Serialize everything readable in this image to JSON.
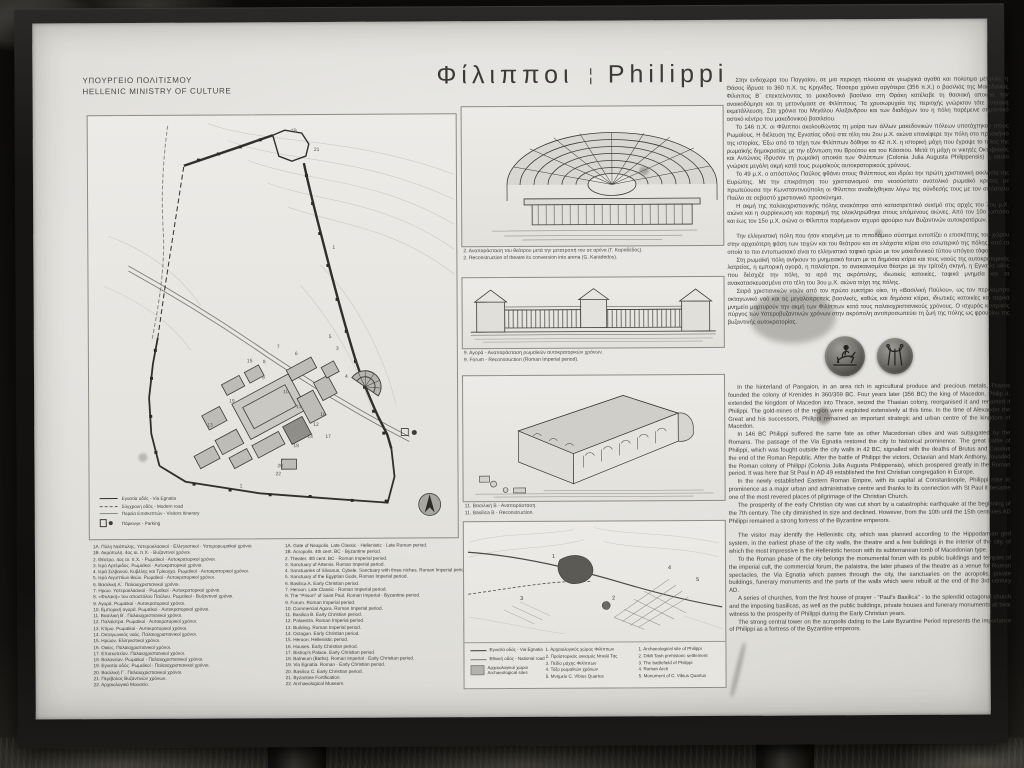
{
  "colors": {
    "frame": "#171513",
    "board": "#e2e1dc",
    "ink": "#3e3e3a",
    "wall_line": "#2f2f2d",
    "coin": "#55544e"
  },
  "header": {
    "ministry_line1": "ΥΠΟΥΡΓΕΙΟ ΠΟΛΙΤΙΣΜΟΥ",
    "ministry_line2": "HELLENIC MINISTRY OF CULTURE",
    "title_greek": "Φίλιπποι",
    "title_divider": "¦",
    "title_english": "Philippi"
  },
  "site_map": {
    "legend": [
      "Εγνατία οδός - Via Egnatia",
      "Σύγχρονη οδός - Modern road",
      "Πορεία Επισκεπτών - Visitors Itinerary",
      "Πάρκινγκ - Parking"
    ]
  },
  "monument_legend": {
    "greek": [
      "1Α. Πύλη Νεάπολης. Υστεροκλασικοί - Ελληνιστικοί - Υστερορωμαϊκοί χρόνοι.",
      "1Β. Ακρόπολη. 4ος αι. π.Χ. - Βυζαντινοί χρόνοι.",
      "2. Θέατρο. 4ος αι. π.Χ. - Ρωμαϊκοί - Αυτοκρατορικοί χρόνοι.",
      "3. Ιερό Αρτέμιδος. Ρωμαϊκοί - Αυτοκρατορικοί χρόνοι.",
      "4. Ιερά Σιλβανού, Κυβέλης και Τρίκογχο. Ρωμαϊκοί - Αυτοκρατορικοί χρόνοι.",
      "5. Ιερό Αιγυπτίων θεών. Ρωμαϊκοί - Αυτοκρατορικοί χρόνοι.",
      "6. Βασιλική Α΄. Παλαιοχριστιανικοί χρόνοι.",
      "7. Ηρώο. Υστεροκλασικοί - Ρωμαϊκοί - Αυτοκρατορικοί χρόνοι.",
      "8. «Φυλακή» του αποστόλου Παύλου. Ρωμαϊκοί - Βυζαντινοί χρόνοι.",
      "9. Αγορά. Ρωμαϊκοί - Αυτοκρατορικοί χρόνοι.",
      "10. Εμπορική αγορά. Ρωμαϊκοί - Αυτοκρατορικοί χρόνοι.",
      "11. Βασιλική Β΄. Παλαιοχριστιανικοί χρόνοι.",
      "12. Παλαίστρα. Ρωμαϊκοί - Αυτοκρατορικοί χρόνοι.",
      "13. Κτίριο. Ρωμαϊκοί - Αυτοκρατορικοί χρόνοι.",
      "14. Οκταγωνικός ναός. Παλαιοχριστιανικοί χρόνοι.",
      "15. Ηρώον. Ελληνιστικοί χρόνοι.",
      "16. Οικίες. Παλαιοχριστιανικοί χρόνοι.",
      "17. Επισκοπείον. Παλαιοχριστιανικοί χρόνοι.",
      "18. Βαλανείον. Ρωμαϊκοί - Παλαιοχριστιανικοί χρόνοι.",
      "19. Εγνατία οδός. Ρωμαϊκοί - Παλαιοχριστιανικοί χρόνοι.",
      "20. Βασιλική Γ΄. Παλαιοχριστιανικοί χρόνοι.",
      "21. Περίβολος Βυζαντινών χρόνων.",
      "22. Αρχαιολογικό Μουσείο."
    ],
    "english": [
      "1A. Gate of Neapolis. Late Classic - Hellenistic - Late Roman period.",
      "1B. Acropolis. 4th cent. BC - Byzantine period.",
      "2. Theater. 4th cent. BC - Roman Imperial period.",
      "3. Sanctuary of Artemis. Roman Imperial period.",
      "4. Sanctuaries of Silvanus, Cybele. Sanctuary with three niches. Roman Imperial period.",
      "5. Sanctuary of the Egyptian Gods. Roman Imperial period.",
      "6. Basilica A. Early Christian period.",
      "7. Heroon. Late Classic - Roman Imperial period.",
      "8. The \"Prison\" of Saint Paul. Roman Imperial - Byzantine period.",
      "9. Forum. Roman Imperial period.",
      "10. Commercial Agora. Roman Imperial period.",
      "11. Basilica B. Early Christian period.",
      "12. Palaestra. Roman Imperial period.",
      "13. Building. Roman Imperial period.",
      "14. Octagon. Early Christian period.",
      "15. Heroon. Hellenistic period.",
      "16. Houses. Early Christian period.",
      "17. Bishop's Palace. Early Christian period.",
      "18. Balneum (Baths). Roman Imperial - Early Christian period.",
      "19. Via Egnatia. Roman - Early Christian period.",
      "20. Basilica C. Early Christian period.",
      "21. Byzantine Fortification.",
      "22. Archaeological Museum."
    ]
  },
  "figures": [
    {
      "greek": "2. Αναπαράσταση του θεάτρου μετά την μετατροπή του σε αρένα (Γ. Καραδέδος).",
      "english": "2. Reconstruction of theatre its conversion into arena (G. Karadedos)."
    },
    {
      "greek": "9. Αγορά - Αναπαράσταση ρωμαϊκών αυτοκρατορικών χρόνων.",
      "english": "9. Forum - Reconstruction (Roman Imperial period)."
    },
    {
      "greek": "11. Βασιλική Β - Αναπαράσταση.",
      "english": "11. Basilica B - Reconstruction."
    }
  ],
  "area_map": {
    "legend_roads": [
      "Εγνατία οδός - Via Egnatia",
      "Εθνική οδός - National road"
    ],
    "legend_sites_greek": "Αρχαιολογικοί χώροι",
    "legend_sites_english": "Archaeological sites",
    "points_greek": [
      "1. Αρχαιολογικός χώρος Φιλίππων",
      "2. Προϊστορικός οικισμός Ντικιλί Τας",
      "3. Πεδίο μάχης Φιλίππων",
      "4. Τόξο ρωμαϊκών χρόνων",
      "5. Μνημείο C. Vibius Quartus"
    ],
    "points_english": [
      "1. Archaeological site of Philippi",
      "2. Dikili Tash prehistoric settlement",
      "3. The battlefield of Philippi",
      "4. Roman Arch",
      "5. Monument of C. Vibius Quartus"
    ]
  },
  "text_greek": {
    "part1": [
      "Στην ενδοχώρα του Παγγαίου, σε μια περιοχή πλούσια σε γεωργικά αγαθά και πολύτιμα μέταλλα, η Θάσος ίδρυσε το 360 π.Χ. τις Κρηνίδες. Τέσσερα χρόνια αργότερα (356 π.Χ.) ο βασιλιάς της Μακεδονίας Φίλιππος Β΄ επεκτείνοντας το μακεδονικό βασίλειο στη Θράκη κατέλαβε τη θασιακή αποικία, την ανοικοδόμησε και τη μετονόμασε σε Φιλίππους. Τα χρυσωρυχεία της περιοχής γνώρισαν τότε εντατική εκμετάλλευση. Στα χρόνια του Μεγάλου Αλεξάνδρου και των διαδόχων του η πόλη παρέμεινε σημαντικό αστικό κέντρο του μακεδονικού βασιλείου.",
      "Το 146 π.Χ. οι Φίλιπποι ακολουθώντας τη μοίρα των άλλων μακεδονικών πόλεων υποτάχτηκαν στους Ρωμαίους. Η διέλευση της Εγνατίας οδού στα τέλη του 2ου μ.Χ. αιώνα επανέφερε την πόλη στο προσκήνιο της ιστορίας. Έξω από τα τείχη των Φιλίππων δόθηκε το 42 π.Χ. η ιστορική μάχη που έγραψε το τέλος της ρωμαϊκής δημοκρατίας με την εξόντωση του Βρούτου και του Κάσσιου. Μετά τη μάχη οι νικητές Οκταβιανός και Αντώνιος ίδρυσαν τη ρωμαϊκή αποικία των Φιλίππων (Colonia Julia Augusta Philippensis) η οποία γνώρισε μεγάλη ακμή κατά τους ρωμαϊκούς αυτοκρατορικούς χρόνους.",
      "Το 49 μ.Χ. ο απόστολος Παύλος φθάνει στους Φιλίππους και ιδρύει την πρώτη χριστιανική εκκλησία της Ευρώπης. Με την επικράτηση του χριστιανισμού στο νεοσύστατο ανατολικό ρωμαϊκό κράτος με πρωτεύουσα την Κωνσταντινούπολη οι Φίλιπποι αναδείχθηκαν λόγω της σύνδεσής τους με τον απόστολο Παύλο σε σεβαστό χριστιανικό προσκύνημα.",
      "Η ακμή της παλαιοχριστιανικής πόλης ανακόπηκε από καταστρεπτικό σεισμό στις αρχές του 7ου μ.Χ. αιώνα και η συρρίκνωση και παρακμή της ολοκληρώθηκε στους επόμενους αιώνες. Από τον 10ο ωστόσο και έως τον 15ο μ.Χ. αιώνα οι Φίλιπποι παρέμειναν ισχυρό φρούριο των Βυζαντινών αυτοκρατόρων."
    ],
    "part2": [
      "Την ελληνιστική πόλη που ήταν κτισμένη με το ιπποδάμειο σύστημα εντοπίζει ο επισκέπτης του χώρου στην αρχαιότερη φάση των τειχών και του θεάτρου και σε ελάχιστα κτίρια στο εσωτερικό της πόλης, από τα οποία το πιο εντυπωσιακό είναι το ελληνιστικό ταφικό ηρώο με τον μακεδονικού τύπου υπόγειο τάφο.",
      "Στη ρωμαϊκή πόλη ανήκουν το μνημειακό forum με τα δημόσια κτίρια και τους ναούς της αυτοκρατορικής λατρείας, η εμπορική αγορά, η παλαίστρα, το ανακαινισμένο θέατρο με την τρίτοξη σκηνή, η Εγνατία οδός που διέσχιζε την πόλη, τα ιερά της ακρόπολης, ιδιωτικές κατοικίες, ταφικά μνημεία και τα ανακατασκευασμένα στα τέλη του 3ου μ.Χ. αιώνα τείχη της πόλης.",
      "Σειρά χριστιανικών ναών από τον πρώτο ευκτήριο οίκο, τη «Βασιλική Παύλου», ως τον περίλαμπρο οκταγωνικό ναό και τις μεγαλοπρεπείς βασιλικές, καθώς και δημόσια κτίρια, ιδιωτικές κατοικίες και ταφικά μνημεία μαρτυρούν την ακμή των Φιλίππων κατά τους παλαιοχριστιανικούς χρόνους. Ο ισχυρός κεντρικός πύργος των Υστεροβυζαντινών χρόνων στην ακρόπολη αντιπροσωπεύει τη ζωή της πόλης ως φρουρίου της βυζαντινής αυτοκρατορίας."
    ]
  },
  "text_english": {
    "part1": [
      "In the hinterland of Pangaion, in an area rich in agricultural produce and precious metals, Thasos founded the colony of Krenides in 360/359 BC. Four years later (356 BC) the king of Macedon, Philip II, extended the kingdom of Macedon into Thrace, seized the Thasian colony, reorganised it and renamed it Philippi. The gold-mines of the region were exploited extensively at this time. In the time of Alexander the Great and his successors, Philippi remained an important strategic and urban centre of the kingdom of Macedon.",
      "In 146 BC Philippi suffered the same fate as other Macedonian cities and was subjugated by the Romans. The passage of the Via Egnatia restored the city to historical prominence. The great battle of Philippi, which was fought outside the city walls in 42 BC, signalled with the deaths of Brutus and Cassius the end of the Roman Republic. After the battle of Philippi the victors, Octavian and Mark Anthony, founded the Roman colony of Philippi (Colonia Julia Augusta Philippensis), which prospered greatly in the Roman period. It was here that St Paul in AD 49 established the first Christian congregation in Europe.",
      "In the newly established Eastern Roman Empire, with its capital at Constantinople, Philippi rose to prominence as a major urban and administrative centre and thanks to its connection with St Paul it became one of the most revered places of pilgrimage of the Christian Church.",
      "The prosperity of the early Christian city was cut short by a catastrophic earthquake at the beginning of the 7th century. The city diminished in size and declined. However, from the 10th until the 15th centuries AD Philippi remained a strong fortress of the Byzantine emperors."
    ],
    "part2": [
      "The visitor may identify the Hellenistic city, which was planned according to the Hippodamian grid system, in the earliest phase of the city walls, the theatre and a few buildings in the interior of the city, of which the most impressive is the Hellenistic heroon with its subterranean tomb of Macedonian type.",
      "To the Roman phase of the city belongs the monumental forum with its public buildings and temples of the imperial cult, the commercial forum, the palaistra, the later phases of the theatre as a venue for Roman spectacles, the Via Egnatia which passes through the city, the sanctuaries on the acropolis, private buildings, funerary monuments and the parts of the walls which were rebuilt at the end of the 3rd century AD.",
      "A series of churches, from the first house of prayer - \"Paul's Basilica\" - to the splendid octagonal church and the imposing basilicas, as well as the public buildings, private houses and funerary monuments all bear witness to the prosperity of Philippi during the Early Christian years.",
      "The strong central tower on the acropolis dating to the Late Byzantine Period represents the importance of Philippi as a fortress of the Byzantine emperors."
    ]
  }
}
